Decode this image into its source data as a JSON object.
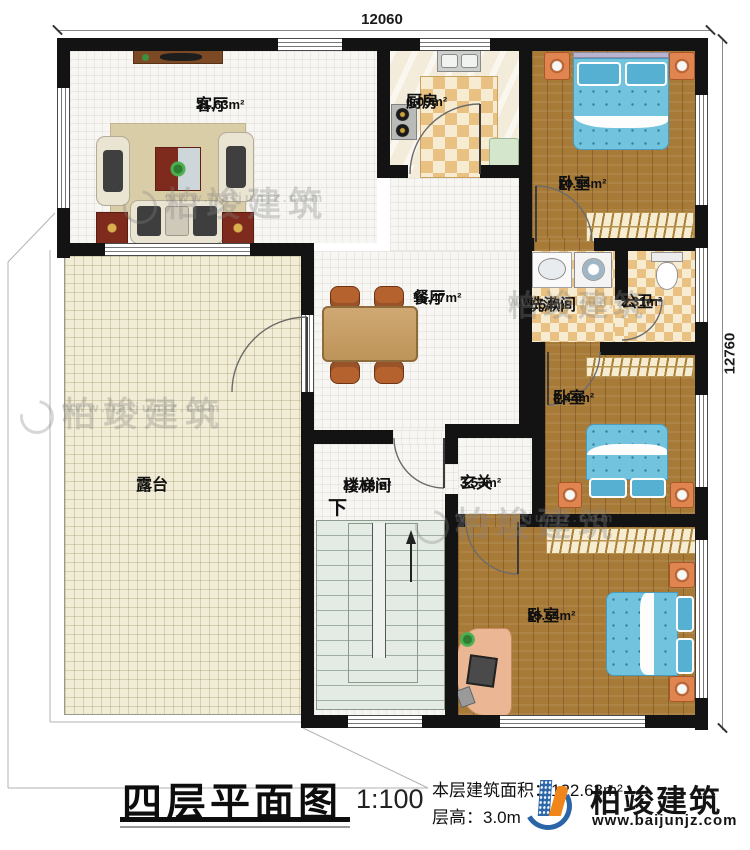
{
  "plan": {
    "dimensions": {
      "top": "12060",
      "right": "12760"
    },
    "rooms": {
      "living": {
        "name": "客厅",
        "area": "21.63m²"
      },
      "kitchen": {
        "name": "厨房",
        "area": "6.09m²"
      },
      "bedroom_top": {
        "name": "卧室",
        "area": "10.94m²"
      },
      "dining": {
        "name": "餐厅",
        "area": "16.47m²"
      },
      "washroom": {
        "name": "洗漱间",
        "area": "2.54m²"
      },
      "toilet": {
        "name": "公卫",
        "area": "2.31m²"
      },
      "bedroom_mid": {
        "name": "卧室",
        "area": "8.44m²"
      },
      "terrace": {
        "name": "露台"
      },
      "stairwell": {
        "name": "楼梯间",
        "area": "12.18m²",
        "direction": "下"
      },
      "foyer": {
        "name": "玄关",
        "area": "3.53m²"
      },
      "bedroom_bottom": {
        "name": "卧室",
        "area": "15.64m²"
      }
    }
  },
  "title_block": {
    "plan_title": "四层平面图",
    "scale": "1:100",
    "floor_area_label": "本层建筑面积：122.63m²",
    "floor_height_label": "层高：3.0m"
  },
  "branding": {
    "company": "柏竣建筑",
    "website": "www.baijunjz.com"
  },
  "watermark": {
    "company": "柏竣建筑",
    "website": "www.baijunjz.com"
  },
  "colors": {
    "wall": "#131313",
    "wood_floor": "#a87a38",
    "bed_blue": "#72c4de",
    "checker_tan": "#e8c183",
    "logo_blue": "#2a65a8",
    "logo_orange": "#f08519"
  }
}
